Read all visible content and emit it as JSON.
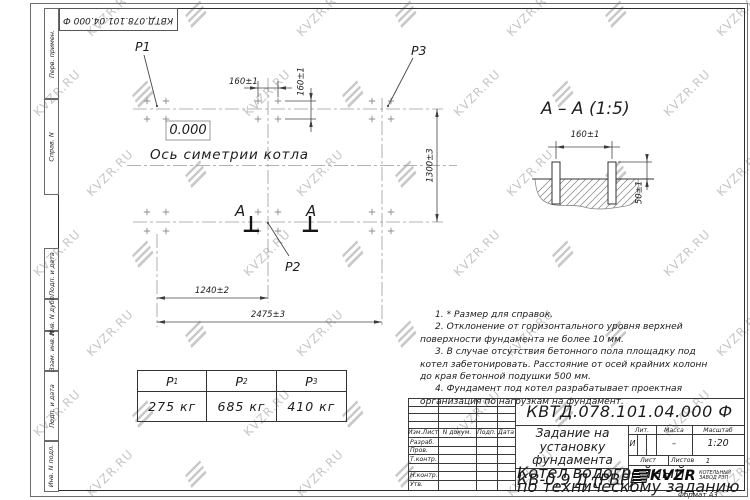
{
  "watermark": {
    "text": "KVZR.RU"
  },
  "stamp": {
    "doc_number": "КВТД.078.101.04.000  Ф"
  },
  "margin_labels": [
    "Перв. примен.",
    "Справ. N",
    "Подп. и дата",
    "Инв. N дубл.",
    "Взам. инв. N",
    "Подп. и дата",
    "Инв. N подл."
  ],
  "plan": {
    "point_labels": {
      "p1": "P1",
      "p2": "P2",
      "p3": "P3"
    },
    "level_mark": "0.000",
    "axis_caption": "Ось симетрии котла",
    "dim_160_top": "160±1",
    "dim_160_side": "160±1",
    "dim_1300": "1300±3",
    "dim_1240": "1240±2",
    "dim_2475": "2475±3",
    "section_mark": "А"
  },
  "section_view": {
    "title": "А – А (1:5)",
    "dim_width": "160±1",
    "dim_height": "50±1"
  },
  "load_table": {
    "headers": [
      {
        "base": "P",
        "sub": "1"
      },
      {
        "base": "P",
        "sub": "2"
      },
      {
        "base": "P",
        "sub": "3"
      }
    ],
    "values": [
      "275 кг",
      "685 кг",
      "410 кг"
    ]
  },
  "notes": [
    "1. * Размер для справок.",
    "2. Отклонение от горизонтального уровня верхней поверхности фундамента не более 10 мм.",
    "3. В случае отсутствия бетонного пола площадку под котел забетонировать. Расстояние от осей крайних колонн до края бетонной подушки 500 мм.",
    "4. Фундамент под котел разрабатывает проектная организация по нагрузкам на фундамент."
  ],
  "title_block": {
    "doc_number": "КВТД.078.101.04.000  Ф",
    "title": "Задание на установку фундамента",
    "product_lines": [
      "Котел водогрейный",
      "КВ-0,9 Д (РВР)",
      "по техническому заданию"
    ],
    "header_cols": [
      "Изм.Лист",
      "N докум.",
      "Подп.",
      "Дата"
    ],
    "signature_rows": [
      "Разраб.",
      "Пров.",
      "Т.контр.",
      "Н.контр.",
      "Утв."
    ],
    "lit_label": "Лит.",
    "lit_value": "И",
    "mass_label": "Масса",
    "mass_value": "–",
    "scale_label": "Масштаб",
    "scale_value": "1:20",
    "sheet_label": "Лист",
    "sheets_label": "Листов",
    "sheets_value": "1",
    "logo_text": "KVZR",
    "logo_caption_lines": [
      "КОТЕЛЬНЫЙ",
      "ЗАВОД РЭП"
    ],
    "format_label": "Формат А3"
  }
}
